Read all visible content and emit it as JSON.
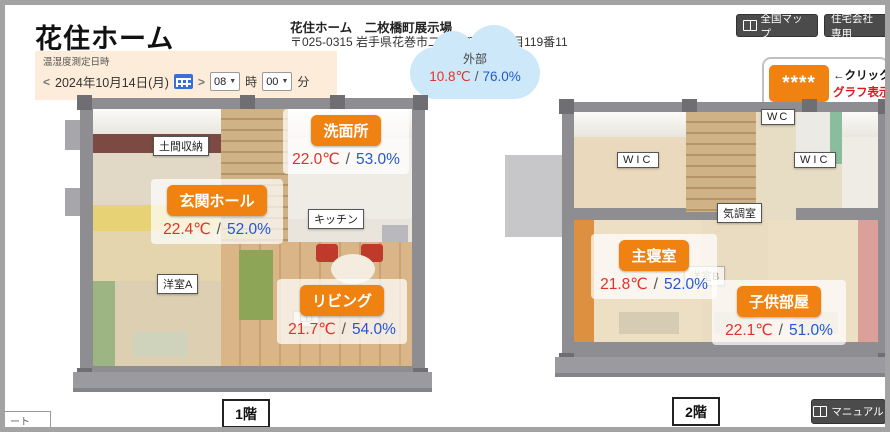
{
  "header": {
    "logo": "花住ホーム",
    "site_name": "花住ホーム　二枚橋町展示場",
    "address": "〒025-0315 岩手県花巻市二枚橋町南一丁目119番11",
    "map_button": "全国マップ",
    "company_button": "住宅会社専用"
  },
  "datetime_panel": {
    "label": "温湿度測定日時",
    "prev_arrow": "<",
    "date": "2024年10月14日(月)",
    "next_arrow": ">",
    "hour_value": "08",
    "hour_unit": "時",
    "minute_value": "00",
    "minute_unit": "分"
  },
  "outside": {
    "label": "外部",
    "temperature": "10.8℃",
    "separator": "/",
    "humidity": "76.0%"
  },
  "graph_link": {
    "stars": "****",
    "click_text": "←クリック",
    "graph_text": "グラフ表示へ"
  },
  "floor1": {
    "caption": "1階",
    "rooms_plain": [
      {
        "name": "土間収納"
      },
      {
        "name": "キッチン"
      },
      {
        "name": "洋室A"
      },
      {
        "name": "LD"
      }
    ],
    "sensors": [
      {
        "name": "洗面所",
        "temperature": "22.0℃",
        "separator": "/",
        "humidity": "53.0%"
      },
      {
        "name": "玄関ホール",
        "temperature": "22.4℃",
        "separator": "/",
        "humidity": "52.0%"
      },
      {
        "name": "リビング",
        "temperature": "21.7℃",
        "separator": "/",
        "humidity": "54.0%"
      }
    ]
  },
  "floor2": {
    "caption": "2階",
    "rooms_plain": [
      {
        "name": "WIC"
      },
      {
        "name": "WC"
      },
      {
        "name": "気調室"
      },
      {
        "name": "WIC"
      },
      {
        "name": "洋室B"
      }
    ],
    "sensors": [
      {
        "name": "主寝室",
        "temperature": "21.8℃",
        "separator": "/",
        "humidity": "52.0%"
      },
      {
        "name": "子供部屋",
        "temperature": "22.1℃",
        "separator": "/",
        "humidity": "51.0%"
      }
    ]
  },
  "footer": {
    "manual_button": "マニュアル",
    "partial_tooltip": "ート"
  },
  "colors": {
    "accent_orange": "#ef8210",
    "temperature_red": "#e03229",
    "humidity_blue": "#2257d6",
    "cloud_blue": "#cde8f9",
    "panel_cream": "#fcecd9",
    "button_dark": "#4b4b4b"
  }
}
